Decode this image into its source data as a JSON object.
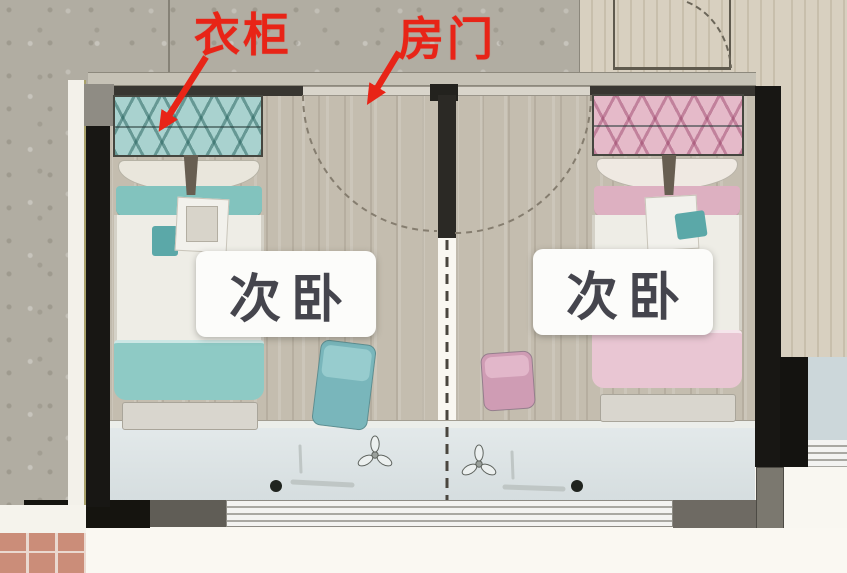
{
  "annotations": {
    "wardrobe": {
      "label": "衣柜"
    },
    "door": {
      "label": "房门"
    },
    "accent_color": "#e82417"
  },
  "rooms": {
    "left": {
      "label": "次卧"
    },
    "right": {
      "label": "次卧"
    }
  },
  "palette": {
    "teal_bed": "#8ecac5",
    "pink_bed": "#e9c6d3",
    "teal_wardrobe": "#a9d2cf",
    "pink_wardrobe": "#e5bac9",
    "wall_black": "#181714",
    "balcony_floor": "#d9e1e2",
    "bedroom_floor": "#c4bdaf",
    "concrete": "#b1ada2",
    "wood": "#d4ccbc",
    "terracotta": "#cb8d79",
    "room_label_text": "#45454d"
  }
}
